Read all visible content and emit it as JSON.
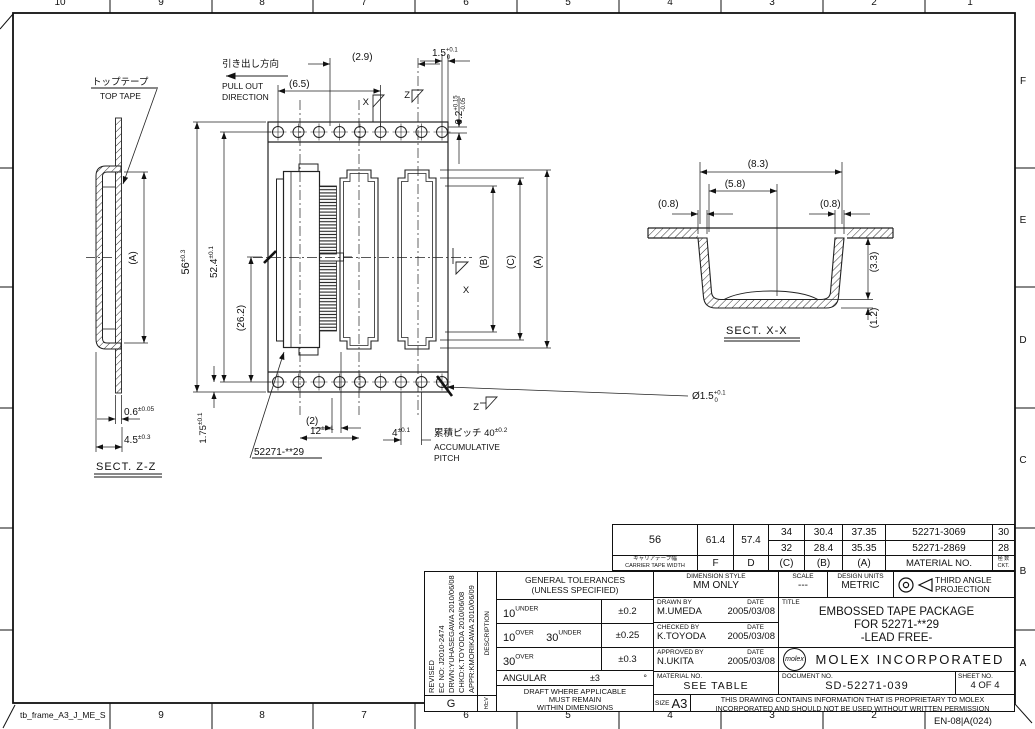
{
  "frame": {
    "name": "tb_frame_A3_J_ME_S",
    "form_no": "EN-08|A(024)",
    "top_zones": [
      "10",
      "9",
      "8",
      "7",
      "6",
      "5",
      "4",
      "3",
      "2",
      "1"
    ],
    "bottom_zones": [
      "9",
      "8",
      "7",
      "6",
      "5",
      "4",
      "3",
      "2"
    ],
    "right_zones": [
      "F",
      "E",
      "D",
      "C",
      "B",
      "A"
    ]
  },
  "drawing": {
    "labels": {
      "top_tape_jp": "トップテープ",
      "top_tape_en": "TOP TAPE",
      "pull_jp": "引き出し方向",
      "pull_en1": "PULL OUT",
      "pull_en2": "DIRECTION",
      "sect_zz": "SECT. Z-Z",
      "sect_xx": "SECT. X-X",
      "callout": "52271-**29",
      "x_mark": "X",
      "z_mark": "Z",
      "acc_en1": "ACCUMULATIVE",
      "acc_en2": "PITCH"
    },
    "dims": {
      "d56": {
        "v": "56",
        "t": "±0.3"
      },
      "d524": {
        "v": "52.4",
        "t": "±0.1"
      },
      "d262": "(26.2)",
      "d65": "(6.5)",
      "d29": "(2.9)",
      "d15": {
        "v": "1.5",
        "up": "+0.1",
        "dn": "0"
      },
      "d02": {
        "v": "0.2",
        "up": "+0.15",
        "dn": "-0.05"
      },
      "d175": {
        "v": "1.75",
        "t": "±0.1"
      },
      "d2": "(2)",
      "d12": {
        "v": "12",
        "t": "±0.1"
      },
      "d4": {
        "v": "4",
        "t": "±0.1"
      },
      "acc": {
        "v": "累積ピッチ 40",
        "t": "±0.2"
      },
      "dia": {
        "v": "Ø1.5",
        "up": "+0.1",
        "dn": "0"
      },
      "d06": {
        "v": "0.6",
        "t": "±0.05"
      },
      "d45": {
        "v": "4.5",
        "t": "±0.3"
      },
      "da": "(A)",
      "db": "(B)",
      "dc": "(C)",
      "da_left": "(A)",
      "d83": "(8.3)",
      "d58": "(5.8)",
      "d08l": "(0.8)",
      "d08r": "(0.8)",
      "d33": "(3.3)",
      "d12b": "(1.2)"
    }
  },
  "parts_table": {
    "carrier_jp": "キャリアテープ幅",
    "carrier_en": "CARRIER TAPE WIDTH",
    "col_f": "F",
    "col_d": "D",
    "col_c": "(C)",
    "col_b": "(B)",
    "col_a": "(A)",
    "col_material": "MATERIAL NO.",
    "ckt_jp": "極 数",
    "ckt_en": "CKT.",
    "width": "56",
    "f": "61.4",
    "d": "57.4",
    "rows": [
      {
        "c": "34",
        "b": "30.4",
        "a": "37.35",
        "material": "52271-3069",
        "ckt": "30"
      },
      {
        "c": "32",
        "b": "28.4",
        "a": "35.35",
        "material": "52271-2869",
        "ckt": "28"
      }
    ]
  },
  "tolerances": {
    "title1": "GENERAL TOLERANCES",
    "title2": "(UNLESS SPECIFIED)",
    "r1a": "10",
    "r1as": "UNDER",
    "r1t": "±0.2",
    "r2a": "10",
    "r2as": "OVER",
    "r2b": "30",
    "r2bs": "UNDER",
    "r2t": "±0.25",
    "r3a": "30",
    "r3as": "OVER",
    "r3t": "±0.3",
    "r4l": "ANGULAR",
    "r4t": "±3",
    "r4u": "°",
    "note1": "DRAFT WHERE APPLICABLE",
    "note2": "MUST REMAIN",
    "note3": "WITHIN DIMENSIONS"
  },
  "revision": {
    "line1": "REVISED",
    "line2": "EC NO: J2010-2474",
    "line3": "DRWN:YUHASEGAWA 2010/06/08",
    "line4": "CHKD:K.TOYODA 2010/06/08",
    "line5": "APPR:KMORIKAWA 2010/06/09",
    "rev_letter": "G",
    "desc_header": "DESCRIPTION",
    "rev_header": "REV"
  },
  "title_block": {
    "dim_style_label": "DIMENSION STYLE",
    "dim_style": "MM ONLY",
    "scale_label": "SCALE",
    "scale": "---",
    "units_label": "DESIGN UNITS",
    "units": "METRIC",
    "proj1": "THIRD ANGLE",
    "proj2": "PROJECTION",
    "drawn_label": "DRAWN BY",
    "date_label": "DATE",
    "drawn": "M.UMEDA",
    "drawn_date": "2005/03/08",
    "checked_label": "CHECKED BY",
    "checked": "K.TOYODA",
    "checked_date": "2005/03/08",
    "approved_label": "APPROVED BY",
    "approved": "N.UKITA",
    "approved_date": "2005/03/08",
    "material_label": "MATERIAL NO.",
    "material": "SEE TABLE",
    "title_label": "TITLE",
    "title1": "EMBOSSED TAPE PACKAGE",
    "title2": "FOR 52271-**29",
    "title3": "-LEAD FREE-",
    "logo": "molex",
    "company": "MOLEX INCORPORATED",
    "doc_label": "DOCUMENT NO.",
    "doc": "SD-52271-039",
    "sheet_label": "SHEET NO.",
    "sheet": "4 OF 4",
    "size_label": "SIZE",
    "size": "A3",
    "prop1": "THIS DRAWING CONTAINS INFORMATION THAT IS PROPRIETARY TO MOLEX",
    "prop2": "INCORPORATED AND SHOULD NOT BE USED WITHOUT WRITTEN PERMISSION"
  }
}
